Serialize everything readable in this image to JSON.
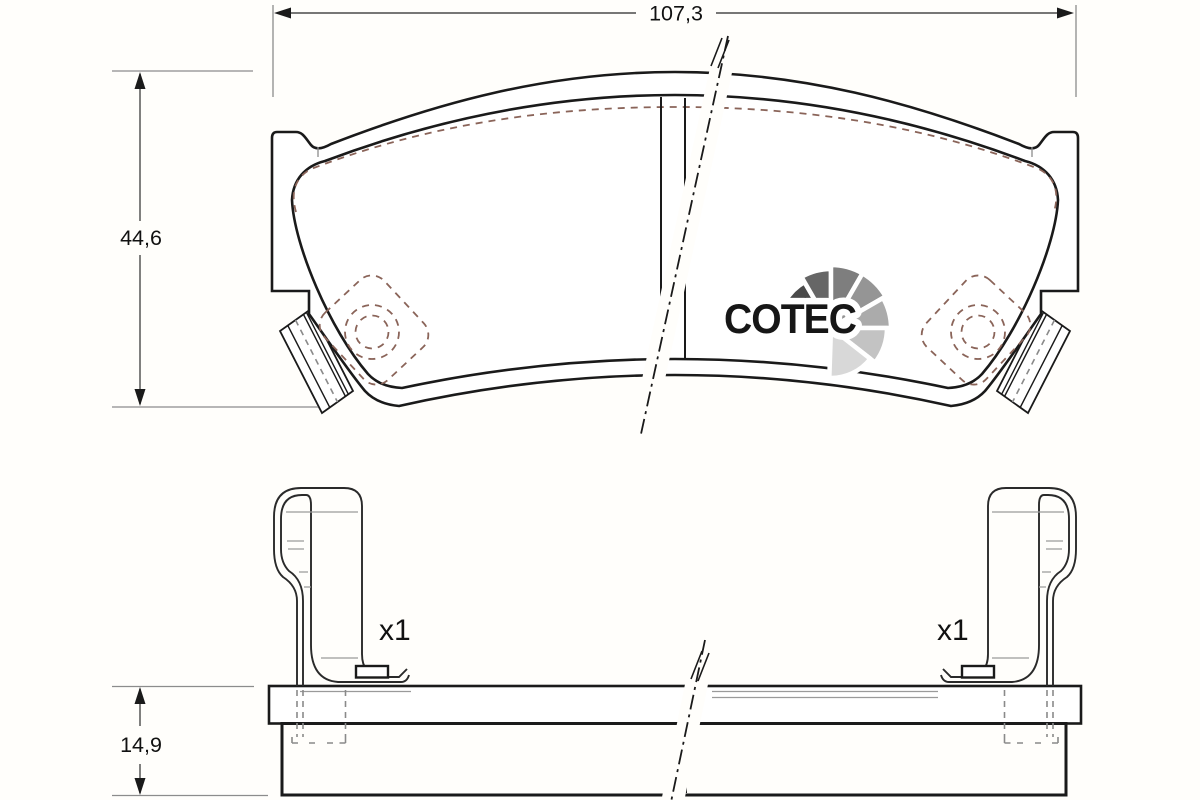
{
  "dimensions": {
    "width": "107,3",
    "height": "44,6",
    "thickness": "14,9"
  },
  "clips": {
    "left_qty": "x1",
    "right_qty": "x1"
  },
  "logo": {
    "text": "COTEC",
    "text_color": "#161616",
    "outline_color": "#ffffff",
    "fan_colors": [
      "#212121",
      "#4a4a4a",
      "#666666",
      "#7e7e7e",
      "#959595",
      "#ababab",
      "#c3c3c3",
      "#d8d8d8"
    ]
  },
  "colors": {
    "friction": "#f5b19c",
    "outline": "#1a1a1a",
    "hidden_dash": "#8a6459",
    "thin_gray": "#8c8c8c",
    "background": "#fffefb"
  }
}
